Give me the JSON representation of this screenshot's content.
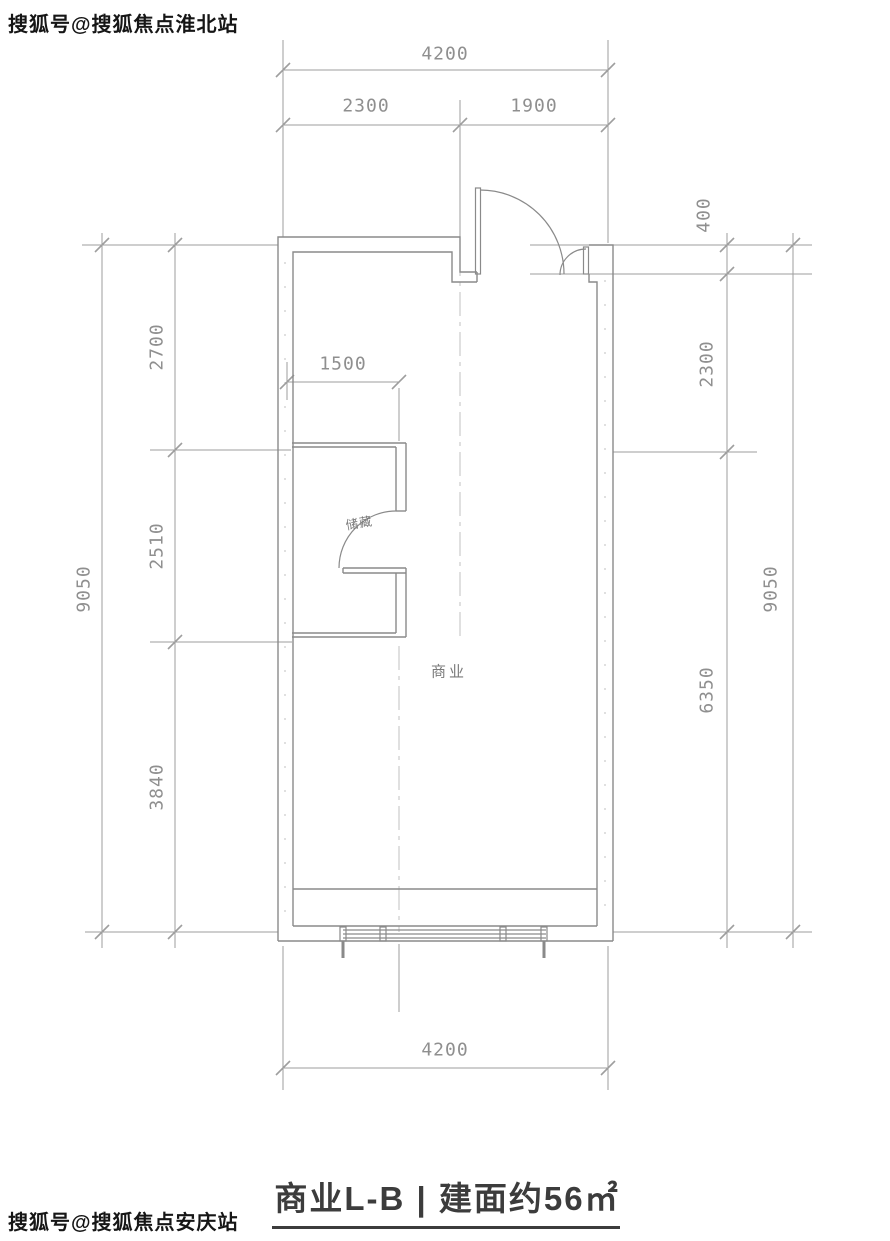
{
  "watermark_top": {
    "text": "搜狐号@搜狐焦点淮北站"
  },
  "watermark_bottom": {
    "text": "搜狐号@搜狐焦点安庆站"
  },
  "floorplan": {
    "rooms": {
      "main_label": "商业",
      "storage_label": "储藏"
    },
    "dimensions": {
      "top": {
        "total": "4200",
        "left": "2300",
        "right": "1900"
      },
      "bottom": {
        "total": "4200"
      },
      "left": {
        "overall": "9050",
        "seg1": "2700",
        "seg2": "2510",
        "seg3": "3840"
      },
      "right": {
        "overall": "9050",
        "seg1": "400",
        "seg2": "2300",
        "seg3": "6350"
      },
      "interior": {
        "storage_width": "1500"
      }
    }
  },
  "caption": {
    "text": "商业L-B | 建面约56㎡"
  },
  "colors": {
    "bg_color": "#ffffff",
    "line_color": "#8a8a8a",
    "dim_line_color": "#9e9e9e",
    "dim_text_color": "#8f8f8f",
    "axis_color": "#bcbcbc",
    "room_text_color": "#7a7a7a",
    "title_text_color": "#3c3c3c",
    "watermark_text_color": "#161616"
  }
}
